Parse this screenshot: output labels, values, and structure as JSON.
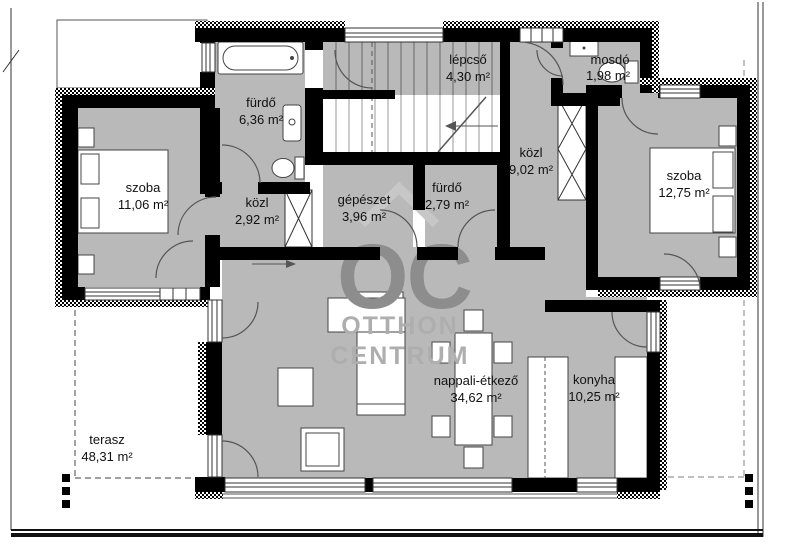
{
  "watermark": {
    "monogram": "OC",
    "line1": "OTTHON",
    "line2": "CENTRUM"
  },
  "rooms": [
    {
      "id": "szoba1",
      "name": "szoba",
      "area": "11,06 m²"
    },
    {
      "id": "furdo1",
      "name": "fürdő",
      "area": "6,36 m²"
    },
    {
      "id": "kozl1",
      "name": "közl",
      "area": "2,92 m²"
    },
    {
      "id": "lepcso",
      "name": "lépcső",
      "area": "4,30 m²"
    },
    {
      "id": "gepeszet",
      "name": "gépészet",
      "area": "3,96 m²"
    },
    {
      "id": "furdo2",
      "name": "fürdő",
      "area": "2,79 m²"
    },
    {
      "id": "kozl2",
      "name": "közl",
      "area": "9,02 m²"
    },
    {
      "id": "mosdo",
      "name": "mosdó",
      "area": "1,98 m²"
    },
    {
      "id": "szoba2",
      "name": "szoba",
      "area": "12,75 m²"
    },
    {
      "id": "nappali",
      "name": "nappali-étkező",
      "area": "34,62 m²"
    },
    {
      "id": "konyha",
      "name": "konyha",
      "area": "10,25 m²"
    },
    {
      "id": "terasz",
      "name": "terasz",
      "area": "48,31 m²"
    }
  ],
  "colors": {
    "floor": "#b9b9b9",
    "wall": "#000000",
    "watermark_dark": "#8d8d8d",
    "watermark_light": "#aeaeae",
    "watermark_roof": "#c7c7c7"
  }
}
